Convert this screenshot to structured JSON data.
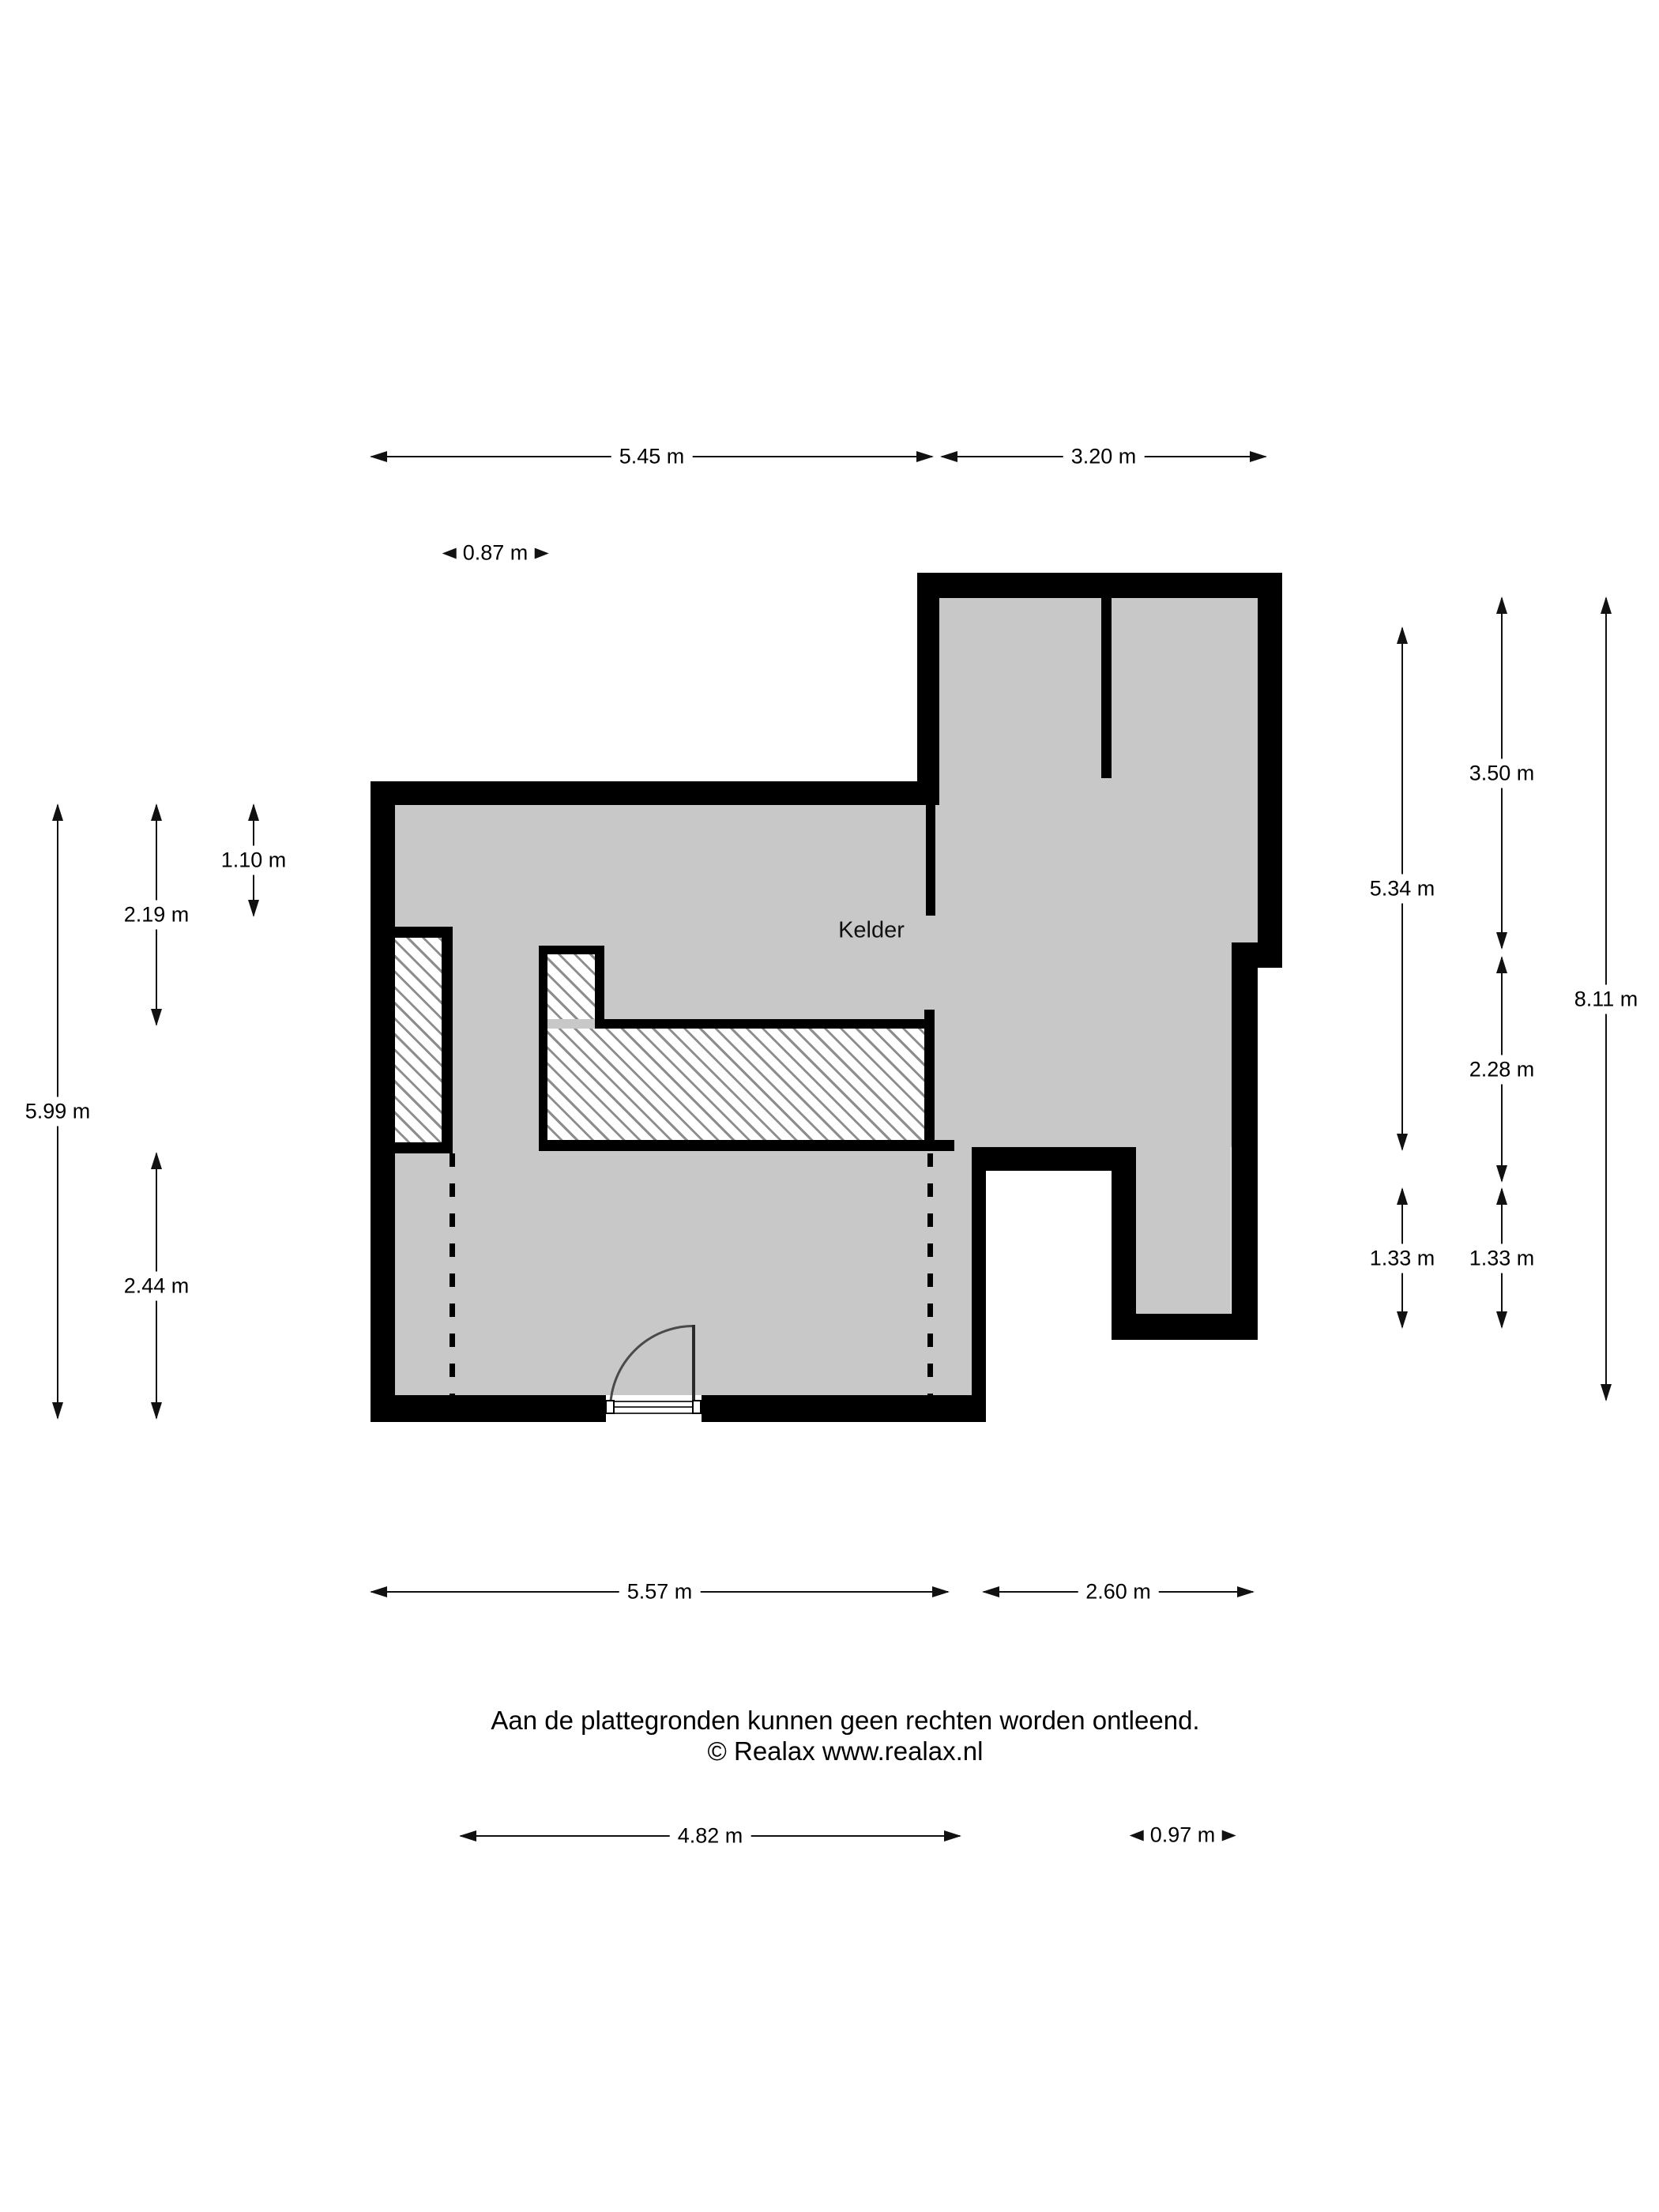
{
  "room": {
    "label": "Kelder"
  },
  "dimensions": {
    "top_main": "5.45 m",
    "top_right": "3.20 m",
    "alcove_width": "0.87 m",
    "left_total": "5.99 m",
    "left_upper": "2.19 m",
    "left_opening": "1.10 m",
    "left_lower": "2.44 m",
    "right_room_height": "5.34 m",
    "right_lower_left": "1.33 m",
    "right_top": "3.50 m",
    "right_middle": "2.28 m",
    "right_lower": "1.33 m",
    "right_total": "8.11 m",
    "bottom_main": "5.57 m",
    "bottom_right": "2.60 m",
    "bottom_inner": "4.82 m",
    "bottom_small": "0.97 m"
  },
  "footer": {
    "line1": "Aan de plattegronden kunnen geen rechten worden ontleend.",
    "line2": "© Realax www.realax.nl"
  },
  "colors": {
    "floor": "#c8c8c8",
    "wall": "#000000",
    "hatch_line": "#8d8d8d",
    "dim": "#111111"
  }
}
